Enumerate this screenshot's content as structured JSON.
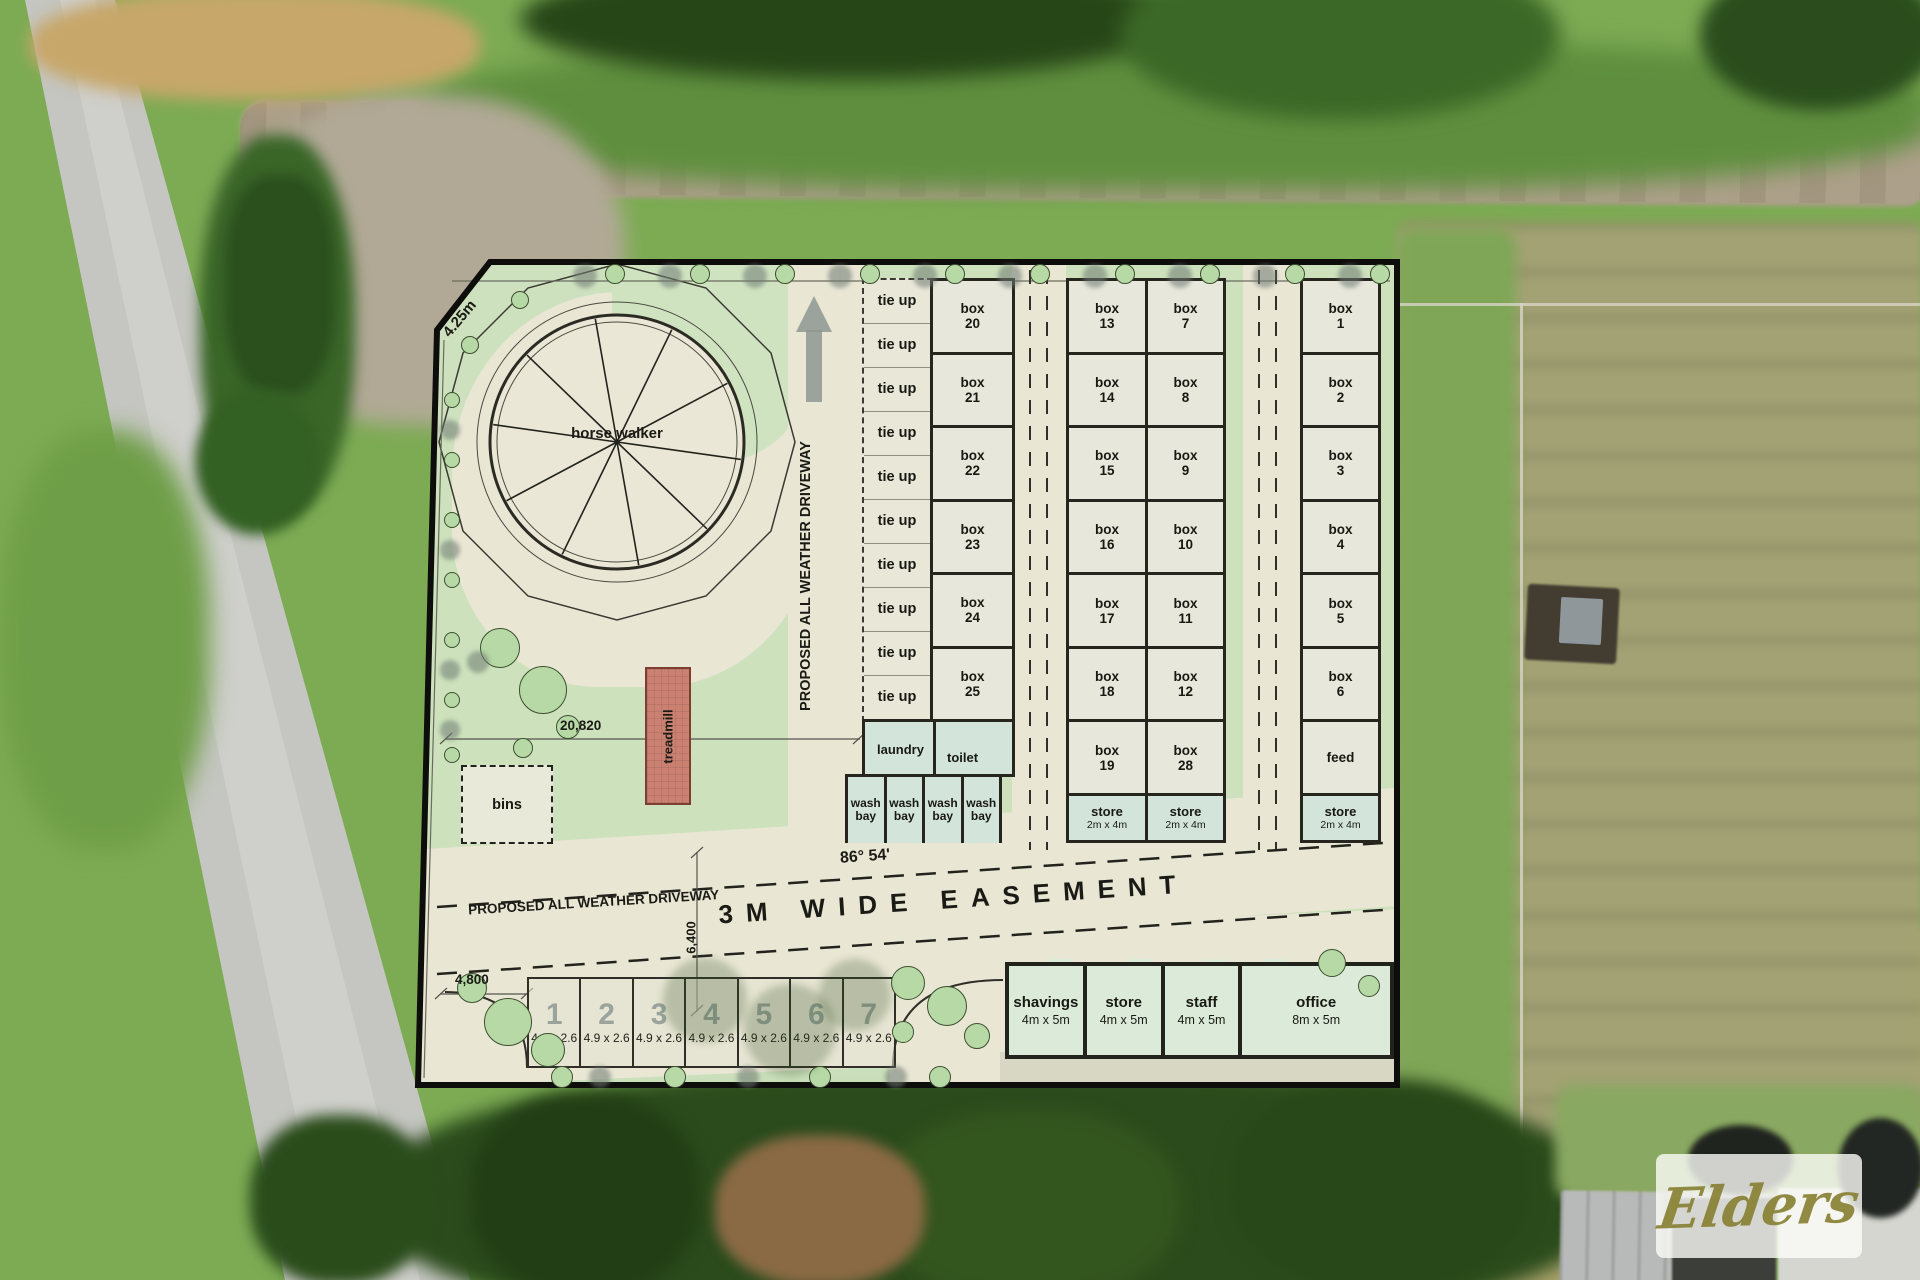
{
  "watermark": {
    "brand": "Elders"
  },
  "plan": {
    "dims": {
      "corner": "4.25m",
      "width": "20,820",
      "easement": "6,400",
      "parking": "4,800",
      "bearing": "86° 54'"
    },
    "labels": {
      "horse_walker": "horse walker",
      "treadmill": "treadmill",
      "bins": "bins",
      "laundry": "laundry",
      "toilet": "toilet",
      "driveway_vertical": "PROPOSED ALL WEATHER DRIVEWAY",
      "driveway_horizontal": "PROPOSED ALL WEATHER DRIVEWAY",
      "easement": "3M WIDE EASEMENT"
    },
    "tie_ups": [
      "tie up",
      "tie up",
      "tie up",
      "tie up",
      "tie up",
      "tie up",
      "tie up",
      "tie up",
      "tie up",
      "tie up"
    ],
    "wash_bays": [
      {
        "l1": "wash",
        "l2": "bay"
      },
      {
        "l1": "wash",
        "l2": "bay"
      },
      {
        "l1": "wash",
        "l2": "bay"
      },
      {
        "l1": "wash",
        "l2": "bay"
      }
    ],
    "stables": {
      "col_a": [
        {
          "t": "box",
          "n": "20"
        },
        {
          "t": "box",
          "n": "21"
        },
        {
          "t": "box",
          "n": "22"
        },
        {
          "t": "box",
          "n": "23"
        },
        {
          "t": "box",
          "n": "24"
        },
        {
          "t": "box",
          "n": "25"
        }
      ],
      "col_b": [
        {
          "t": "box",
          "n": "13"
        },
        {
          "t": "box",
          "n": "14"
        },
        {
          "t": "box",
          "n": "15"
        },
        {
          "t": "box",
          "n": "16"
        },
        {
          "t": "box",
          "n": "17"
        },
        {
          "t": "box",
          "n": "18"
        },
        {
          "t": "box",
          "n": "19"
        }
      ],
      "col_c": [
        {
          "t": "box",
          "n": "7"
        },
        {
          "t": "box",
          "n": "8"
        },
        {
          "t": "box",
          "n": "9"
        },
        {
          "t": "box",
          "n": "10"
        },
        {
          "t": "box",
          "n": "11"
        },
        {
          "t": "box",
          "n": "12"
        },
        {
          "t": "box",
          "n": "28"
        }
      ],
      "col_d": [
        {
          "t": "box",
          "n": "1"
        },
        {
          "t": "box",
          "n": "2"
        },
        {
          "t": "box",
          "n": "3"
        },
        {
          "t": "box",
          "n": "4"
        },
        {
          "t": "box",
          "n": "5"
        },
        {
          "t": "box",
          "n": "6"
        },
        {
          "t": "feed",
          "n": ""
        }
      ],
      "stores": [
        {
          "name": "store",
          "size": "2m x 4m"
        },
        {
          "name": "store",
          "size": "2m x 4m"
        },
        {
          "name": "store",
          "size": "2m x 4m"
        }
      ]
    },
    "parking": {
      "spaces": [
        {
          "n": "1",
          "s": "4.9 x 2.6"
        },
        {
          "n": "2",
          "s": "4.9 x 2.6"
        },
        {
          "n": "3",
          "s": "4.9 x 2.6"
        },
        {
          "n": "4",
          "s": "4.9 x 2.6"
        },
        {
          "n": "5",
          "s": "4.9 x 2.6"
        },
        {
          "n": "6",
          "s": "4.9 x 2.6"
        },
        {
          "n": "7",
          "s": "4.9 x 2.6"
        }
      ]
    },
    "building": {
      "rooms": [
        {
          "name": "shavings",
          "size": "4m x 5m"
        },
        {
          "name": "store",
          "size": "4m x 5m"
        },
        {
          "name": "staff",
          "size": "4m x 5m"
        },
        {
          "name": "office",
          "size": "8m x 5m"
        }
      ]
    }
  }
}
